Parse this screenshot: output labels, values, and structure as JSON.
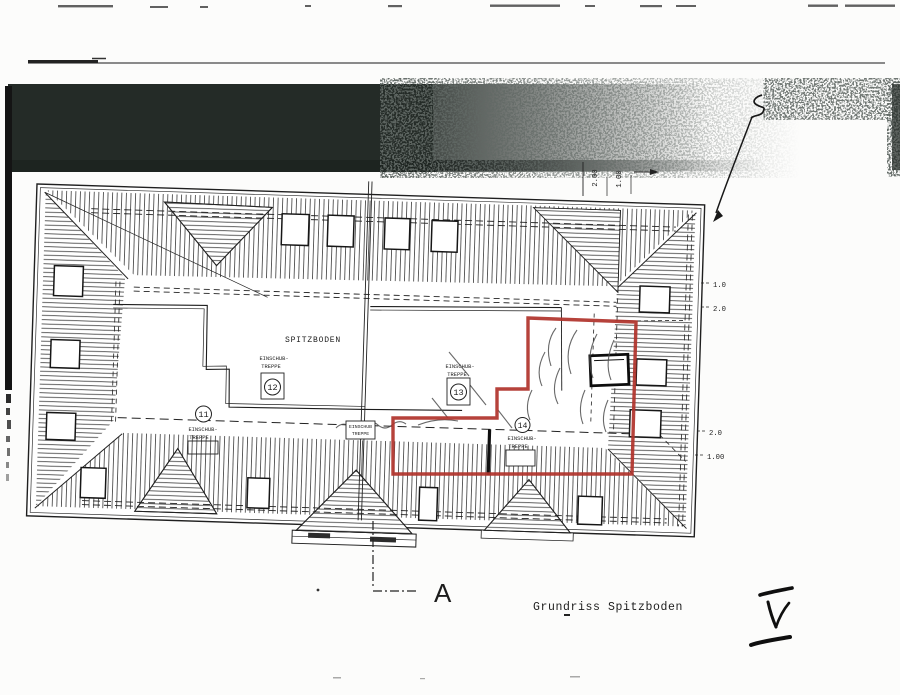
{
  "title": {
    "text": "Grundriss Spitzboden"
  },
  "section": {
    "label": "A"
  },
  "plan": {
    "room_label": "SPITZBODEN",
    "stairs": [
      {
        "num": "11",
        "line1": "EINSCHUB-",
        "line2": "TREPPE"
      },
      {
        "num": "12",
        "line1": "EINSCHUB-",
        "line2": "TREPPE"
      },
      {
        "num": "13",
        "line1": "EINSCHUB-",
        "line2": "TREPPE"
      },
      {
        "num": "14",
        "line1": "EINSCHUB-",
        "line2": "TREPPE"
      }
    ],
    "hatch_box": {
      "line1": "EINSCHUB",
      "line2": "TREPPE"
    },
    "dimensions": {
      "top_rotated": [
        "2.00",
        "1.00"
      ],
      "right_upper": [
        "1.0",
        "2.0"
      ],
      "right_lower": [
        "2.0",
        "1.00"
      ]
    }
  },
  "colors": {
    "highlight_red": "#b0342c",
    "ink": "#222222",
    "scan_band": "#242b27"
  },
  "icons": {
    "arrow": "curved-arrow-icon",
    "handwritten_mark": "handwritten-check-icon"
  }
}
